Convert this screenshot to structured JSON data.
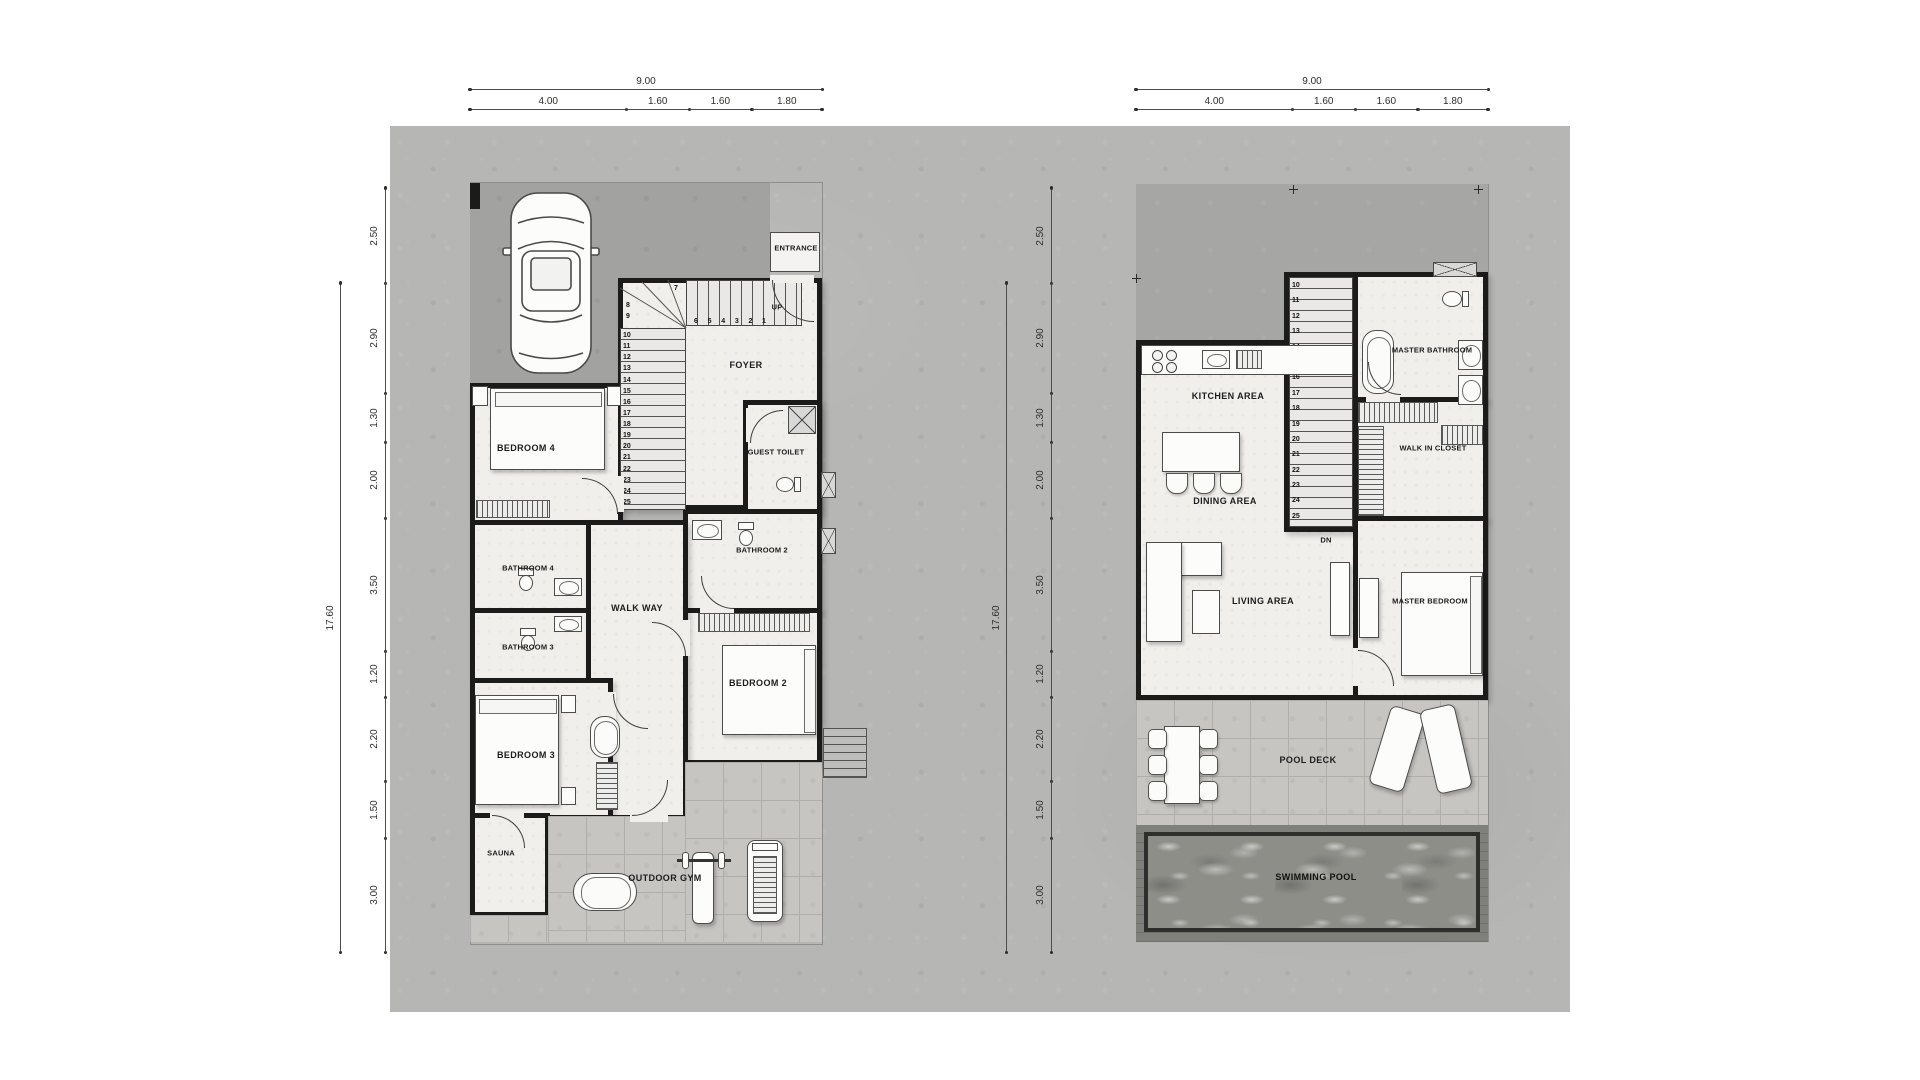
{
  "sheet": {
    "background_color": "#ffffff",
    "canvas_color": "#b6b6b4",
    "wall_color": "#1b1b1a",
    "floor_color": "#f0efec",
    "roof_color": "#a6a6a4",
    "pool_water_color": "#8e8e89"
  },
  "dim_top": {
    "total": "9.00",
    "segments": [
      "4.00",
      "1.60",
      "1.60",
      "1.80"
    ]
  },
  "dim_side": {
    "total": "17.60",
    "segments": [
      "2.50",
      "2.90",
      "1.30",
      "2.00",
      "3.50",
      "1.20",
      "2.20",
      "1.50",
      "3.00"
    ]
  },
  "ground_floor": {
    "labels": {
      "entrance": "ENTRANCE",
      "up": "UP",
      "foyer": "FOYER",
      "guest_toilet": "GUEST TOILET",
      "bedroom4": "BEDROOM 4",
      "bathroom4": "BATHROOM 4",
      "bathroom3": "BATHROOM 3",
      "walkway": "WALK WAY",
      "bathroom2": "BATHROOM 2",
      "bedroom2": "BEDROOM 2",
      "bedroom3": "BEDROOM 3",
      "sauna": "SAUNA",
      "outdoor_gym": "OUTDOOR GYM"
    },
    "stair": {
      "run_numbers": [
        "6",
        "5",
        "4",
        "3",
        "2",
        "1"
      ],
      "turn_numbers": [
        "7",
        "8",
        "9"
      ],
      "flight_numbers": [
        "10",
        "11",
        "12",
        "13",
        "14",
        "15",
        "16",
        "17",
        "18",
        "19",
        "20",
        "21",
        "22",
        "23",
        "24",
        "25"
      ]
    }
  },
  "upper_floor": {
    "labels": {
      "kitchen": "KITCHEN AREA",
      "dining": "DINING AREA",
      "living": "LIVING  AREA",
      "master_bathroom": "MASTER BATHROOM",
      "walk_in_closet": "WALK IN CLOSET",
      "master_bedroom": "MASTER BEDROOM",
      "pool_deck": "POOL DECK",
      "swimming_pool": "SWIMMING POOL",
      "down": "DN"
    },
    "stair": {
      "flight_numbers": [
        "10",
        "11",
        "12",
        "13",
        "14",
        "15",
        "16",
        "17",
        "18",
        "19",
        "20",
        "21",
        "22",
        "23",
        "24",
        "25"
      ]
    }
  }
}
